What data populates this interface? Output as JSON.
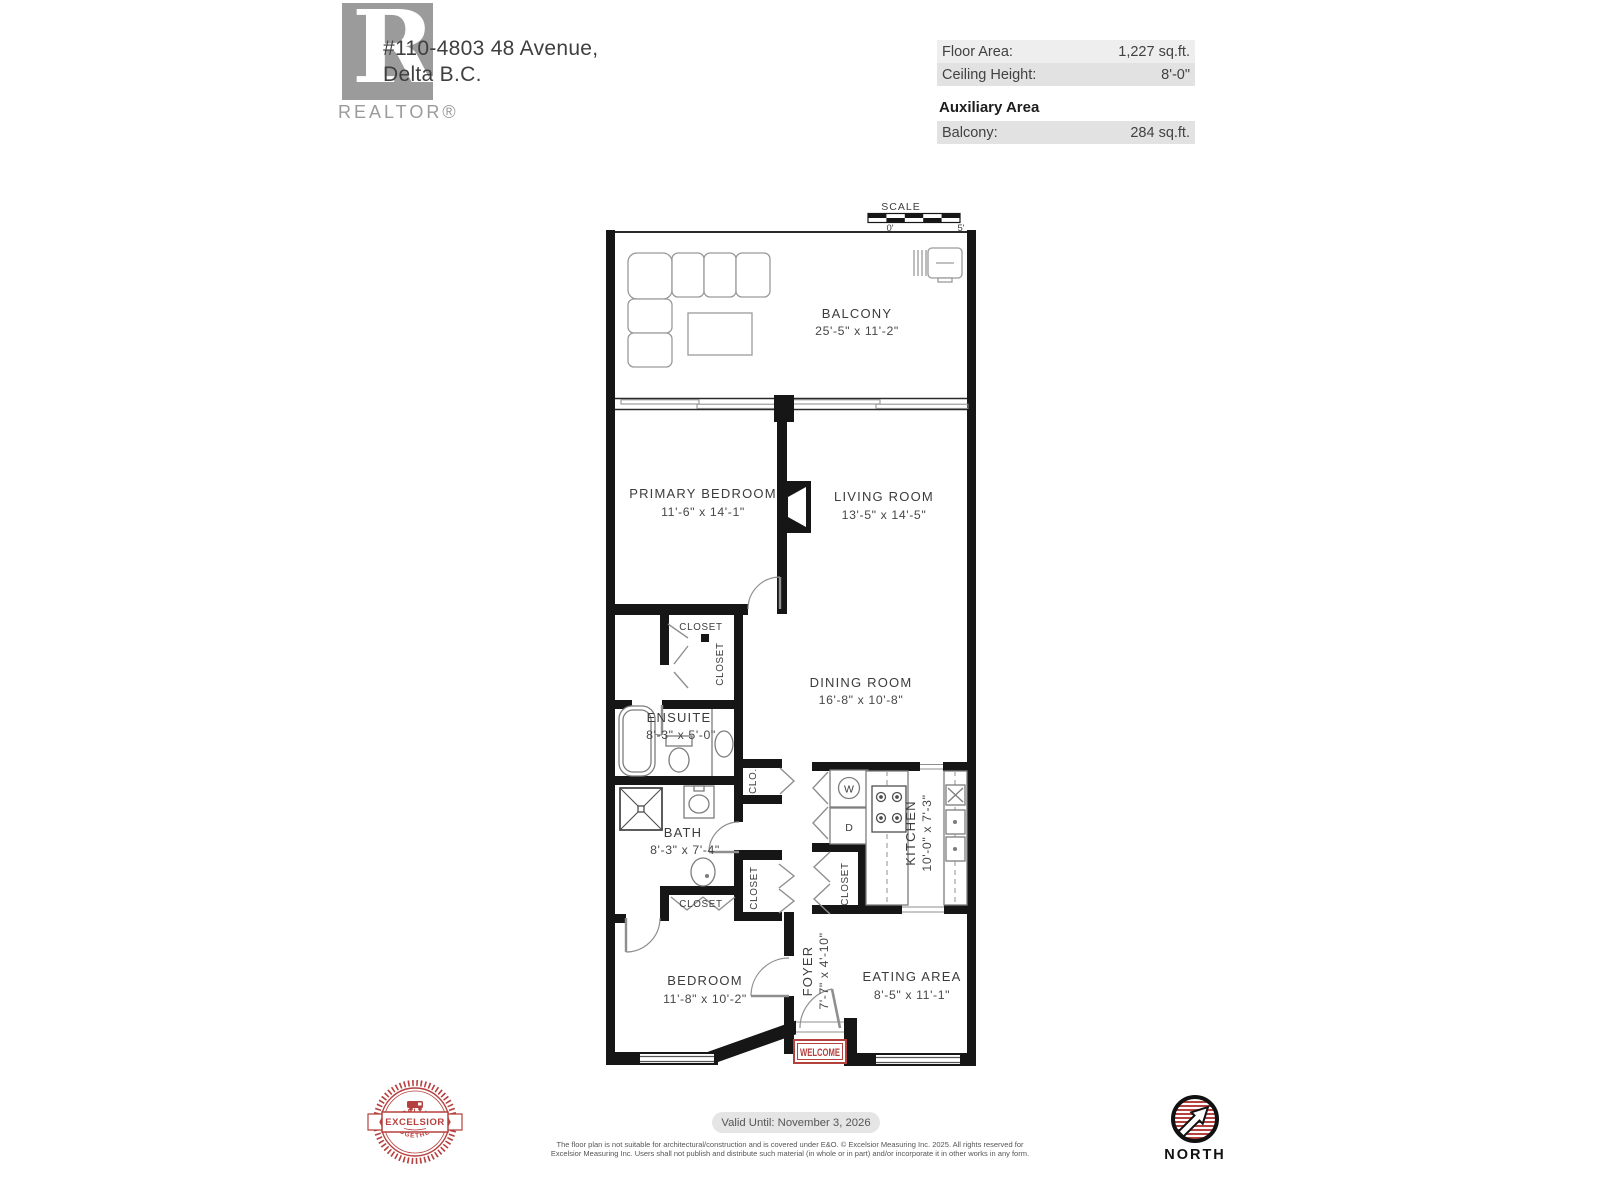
{
  "header": {
    "logo_letter": "R",
    "logo_brand": "REALTOR®",
    "address_line1": "#110-4803 48 Avenue,",
    "address_line2": "Delta B.C.",
    "info": {
      "floor_area_label": "Floor Area:",
      "floor_area_value": "1,227 sq.ft.",
      "ceiling_height_label": "Ceiling Height:",
      "ceiling_height_value": "8'-0\"",
      "auxiliary_title": "Auxiliary Area",
      "balcony_label": "Balcony:",
      "balcony_value": "284 sq.ft."
    }
  },
  "scale_bar": {
    "label": "SCALE",
    "start": "0'",
    "end": "5'"
  },
  "rooms": {
    "balcony": {
      "name": "BALCONY",
      "dims": "25'-5\" x 11'-2\""
    },
    "primary_bedroom": {
      "name": "PRIMARY BEDROOM",
      "dims": "11'-6\" x 14'-1\""
    },
    "living_room": {
      "name": "LIVING ROOM",
      "dims": "13'-5\" x 14'-5\""
    },
    "dining_room": {
      "name": "DINING ROOM",
      "dims": "16'-8\" x 10'-8\""
    },
    "ensuite": {
      "name": "ENSUITE",
      "dims": "8'-3\" x 5'-0\""
    },
    "bath": {
      "name": "BATH",
      "dims": "8'-3\" x 7'-4\""
    },
    "kitchen": {
      "name": "KITCHEN",
      "dims": "10'-0\" x 7'-3\""
    },
    "bedroom": {
      "name": "BEDROOM",
      "dims": "11'-8\" x 10'-2\""
    },
    "foyer": {
      "name": "FOYER",
      "dims": "7'-7\" x 4'-10\""
    },
    "eating_area": {
      "name": "EATING AREA",
      "dims": "8'-5\" x 11'-1\""
    }
  },
  "fixtures": {
    "closet": "CLOSET",
    "clo": "CLO.",
    "washer": "W",
    "dryer": "D",
    "welcome": "WELCOME"
  },
  "footer": {
    "valid_until": "Valid Until: November 3, 2026",
    "disclaimer_line1": "The floor plan is not suitable for architectural/construction and is covered under E&O. © Excelsior Measuring Inc. 2025. All rights reserved for",
    "disclaimer_line2": "Excelsior Measuring Inc. Users shall not publish and distribute such material (in whole or in part) and/or incorporate it in other works in any form.",
    "north_label": "NORTH",
    "badge": {
      "arc_top": "· EXCELLING ·",
      "banner": "EXCELSIOR",
      "arc_bottom": "· TOGETHER ·"
    }
  },
  "colors": {
    "accent_red": "#b5413f",
    "wall_black": "#161616"
  }
}
